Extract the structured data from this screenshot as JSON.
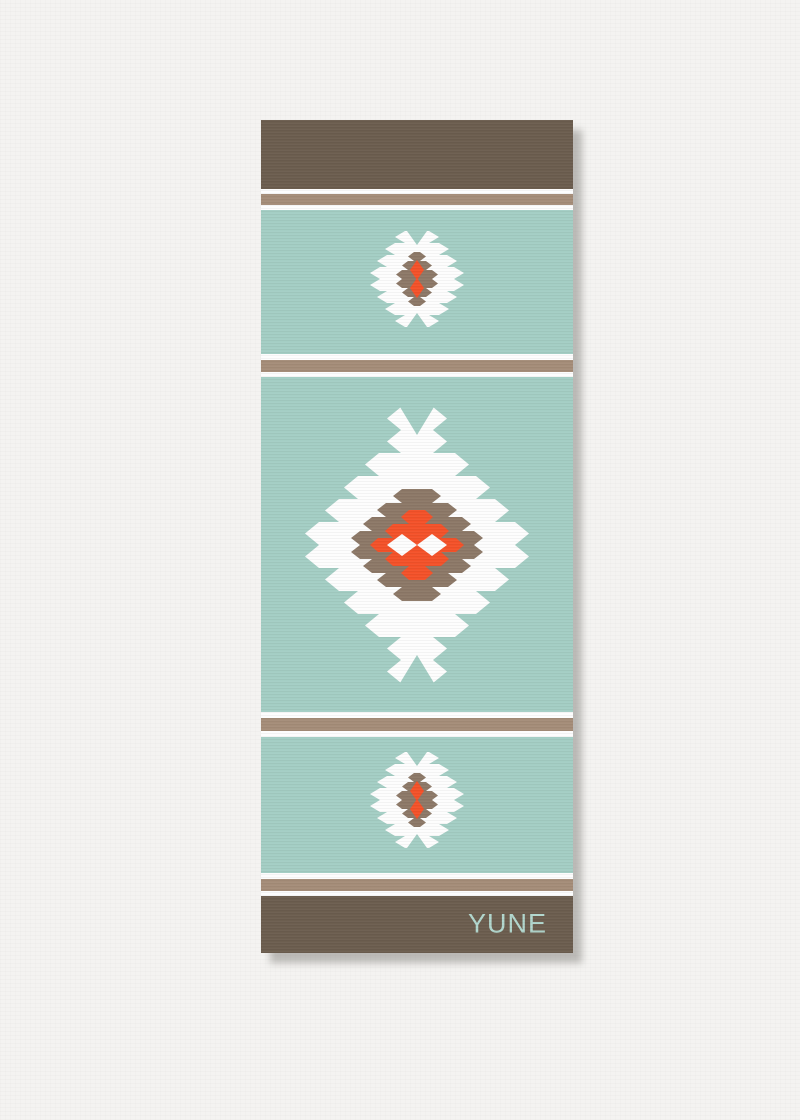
{
  "brand": {
    "label": "YUNE"
  },
  "colors": {
    "paper": "#f4f3f1",
    "band_brown": "#6c5e4f",
    "stripe_tan": "#a58d79",
    "teal": "#a4cec4",
    "motif_white": "#fdfdfd",
    "motif_taupe": "#8d7968",
    "accent_orange": "#f4522a",
    "brand_text": "#b2d7ce"
  },
  "motifs": [
    {
      "name": "aztec-diamond-motif-small-top"
    },
    {
      "name": "aztec-diamond-motif-large-center"
    },
    {
      "name": "aztec-diamond-motif-small-bottom"
    }
  ]
}
